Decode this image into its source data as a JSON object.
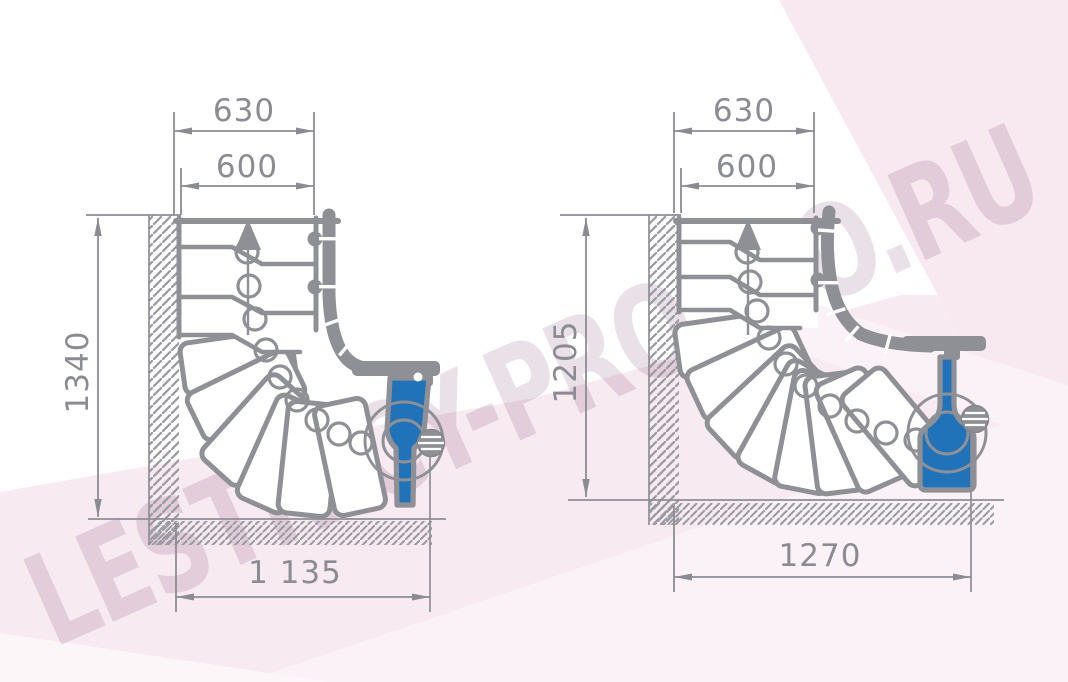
{
  "watermark": {
    "text": "LESTNICY-PROSTO.RU"
  },
  "colors": {
    "line_gray": "#8f9096",
    "dimension_gray": "#8b8c93",
    "post_blue": "#2173b9",
    "background_pink": "#f8e9f0",
    "background_pink_light": "#fcf4f8",
    "watermark_tint": "#e9dfe7"
  },
  "diagrams": {
    "left": {
      "title": "quarter-turn-staircase-plan-left",
      "width_total": "630",
      "width_clear": "600",
      "depth": "1340",
      "width_bottom": "1 135"
    },
    "right": {
      "title": "quarter-turn-staircase-plan-right",
      "width_total": "630",
      "width_clear": "600",
      "depth": "1205",
      "width_bottom": "1270"
    }
  }
}
